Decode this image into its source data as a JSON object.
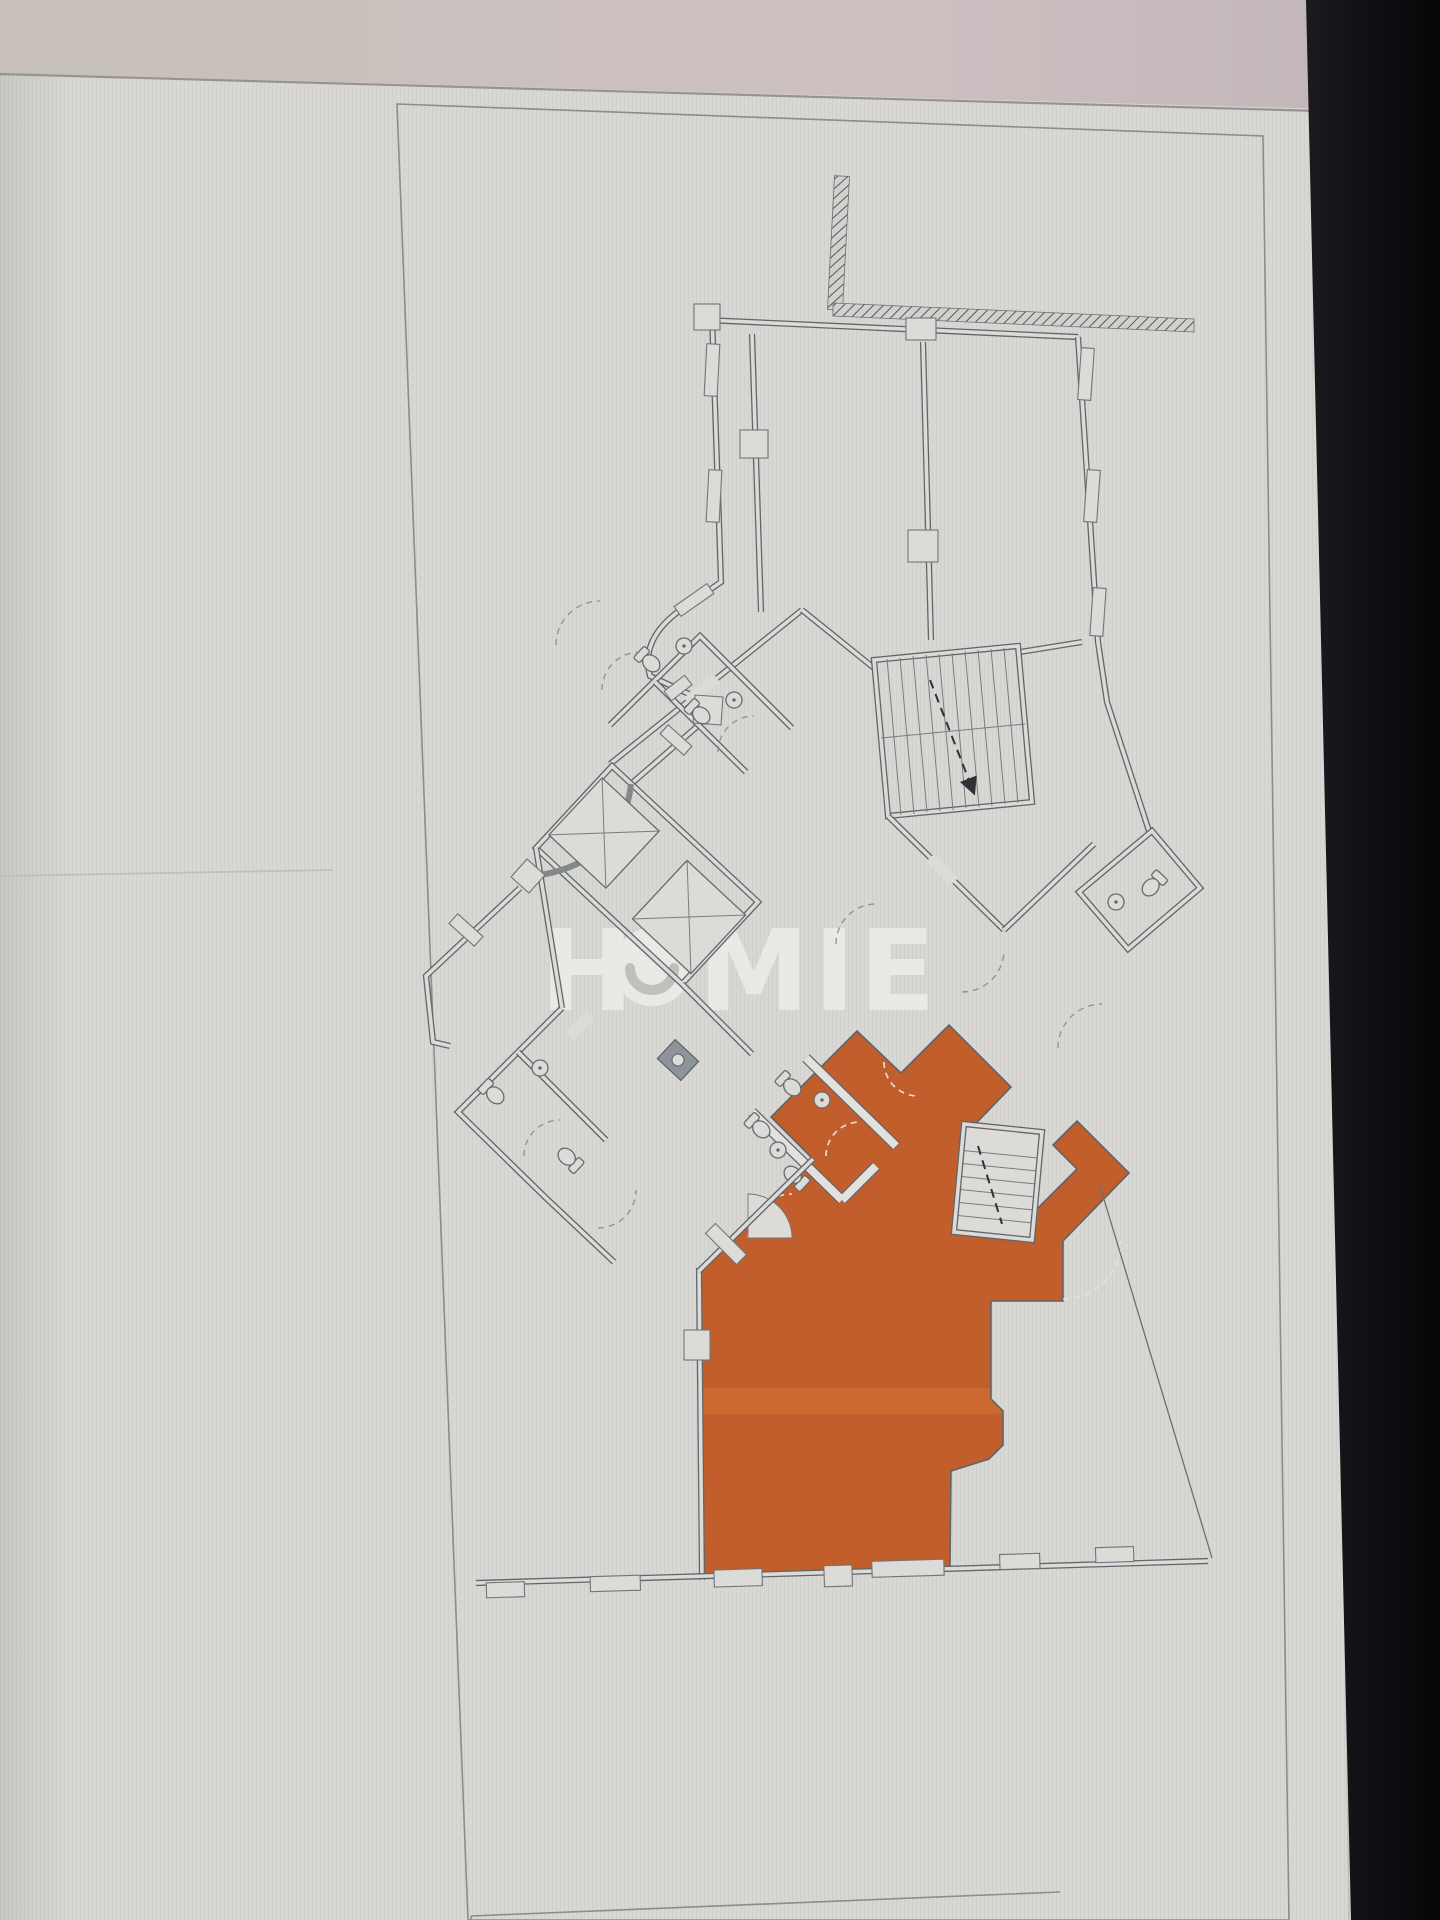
{
  "scene": {
    "kind": "photo of a computer monitor displaying an architectural floor-plan sheet",
    "highlighted_unit": "one unit filled in orange at lower center of the plan"
  },
  "watermark": {
    "text": "HOMIE",
    "left": "H",
    "right": "MIE",
    "o_style": "white circle with gray smile arc"
  },
  "colors": {
    "page_bg": "#d8d7d3",
    "top_band": "#c8c0ba",
    "top_band_pink": "#cdbfc2",
    "bezel_black": "#0b0b0e",
    "wall_line": "#61666b",
    "glass_wall": "#83888c",
    "highlight_orange": "#c25d2c",
    "watermark_white": "#efeeea",
    "frame_line": "#8a8c8e"
  },
  "plan_features": [
    "hatched existing boundary wall (top)",
    "exterior walls with window mullions",
    "curved glass facade (left)",
    "central core rotated 45 degrees",
    "two elevator shafts with X",
    "main stair with dashed up-arrow",
    "secondary stair beside orange unit",
    "wc toilets and sinks",
    "dashed door-swing arcs",
    "orange highlighted unit with internal wc partitions",
    "sheet border frame",
    "next sheet edge at bottom"
  ]
}
